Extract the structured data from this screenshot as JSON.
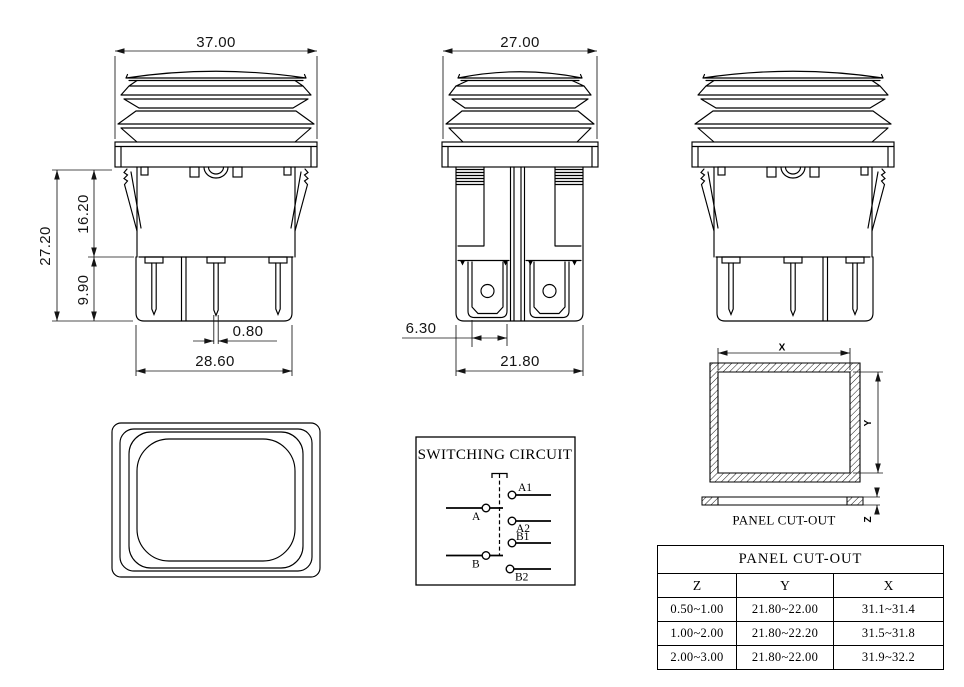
{
  "drawing": {
    "background_color": "#ffffff",
    "line_color": "#000000"
  },
  "front_view": {
    "dim_flange_width": "37.00",
    "dim_total_height": "27.20",
    "dim_body_height": "16.20",
    "dim_terminal_length": "9.90",
    "dim_pin_thickness": "0.80",
    "dim_body_width": "28.60"
  },
  "side_view": {
    "dim_flange_width": "27.00",
    "dim_terminal_width": "6.30",
    "dim_body_width": "21.80"
  },
  "switching_circuit": {
    "title": "SWITCHING CIRCUIT",
    "terminals": {
      "a1": "A1",
      "a": "A",
      "a2": "A2",
      "b1": "B1",
      "b": "B",
      "b2": "B2"
    }
  },
  "panel_cutout_drawing": {
    "caption": "PANEL CUT-OUT",
    "dim_x": "X",
    "dim_y": "Y",
    "dim_z": "Z"
  },
  "panel_cutout_table": {
    "title": "PANEL CUT-OUT",
    "headers": [
      "Z",
      "Y",
      "X"
    ],
    "rows": [
      [
        "0.50~1.00",
        "21.80~22.00",
        "31.1~31.4"
      ],
      [
        "1.00~2.00",
        "21.80~22.20",
        "31.5~31.8"
      ],
      [
        "2.00~3.00",
        "21.80~22.00",
        "31.9~32.2"
      ]
    ]
  }
}
